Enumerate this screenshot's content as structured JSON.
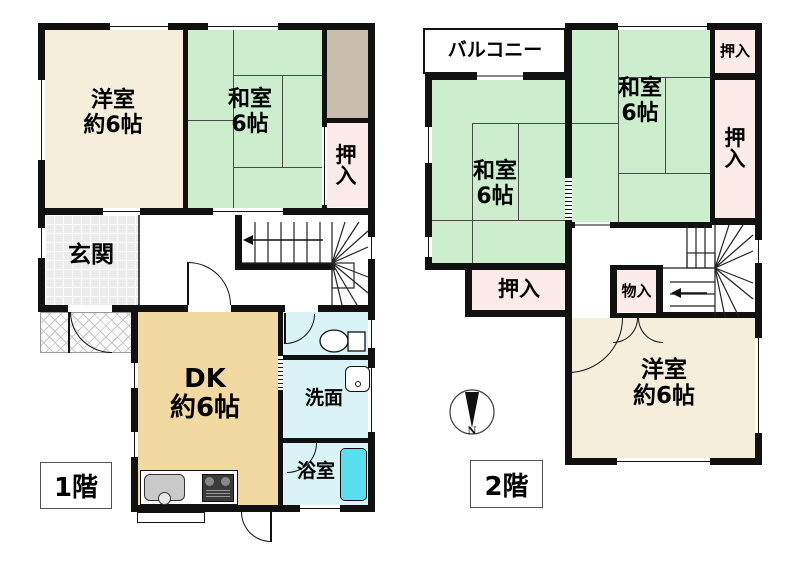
{
  "floor1": {
    "label": "1階",
    "western_room": {
      "name": "洋室",
      "size": "約6帖"
    },
    "japanese_room": {
      "name": "和室",
      "size": "6帖"
    },
    "closet": "押入",
    "entrance": "玄関",
    "dining_kitchen": {
      "name": "DK",
      "size": "約6帖"
    },
    "washroom": "洗面",
    "bathroom": "浴室"
  },
  "floor2": {
    "label": "2階",
    "balcony": "バルコニー",
    "japanese_room_left": {
      "name": "和室",
      "size": "6帖"
    },
    "japanese_room_right": {
      "name": "和室",
      "size": "6帖"
    },
    "closet_top": "押入",
    "closet_right": "押入",
    "closet_bottom": "押入",
    "storage": "物入",
    "western_room": {
      "name": "洋室",
      "size": "約6帖"
    }
  },
  "compass": {
    "north_label": "N"
  },
  "colors": {
    "japanese_room": "#cdeecd",
    "western_room": "#f5eedb",
    "closet": "#fcebe9",
    "dining_kitchen": "#f2d9a2",
    "wet_area": "#d9f3f7",
    "bathtub": "#59dfee",
    "storage_brown": "#c9bdae",
    "wall": "#111111"
  }
}
